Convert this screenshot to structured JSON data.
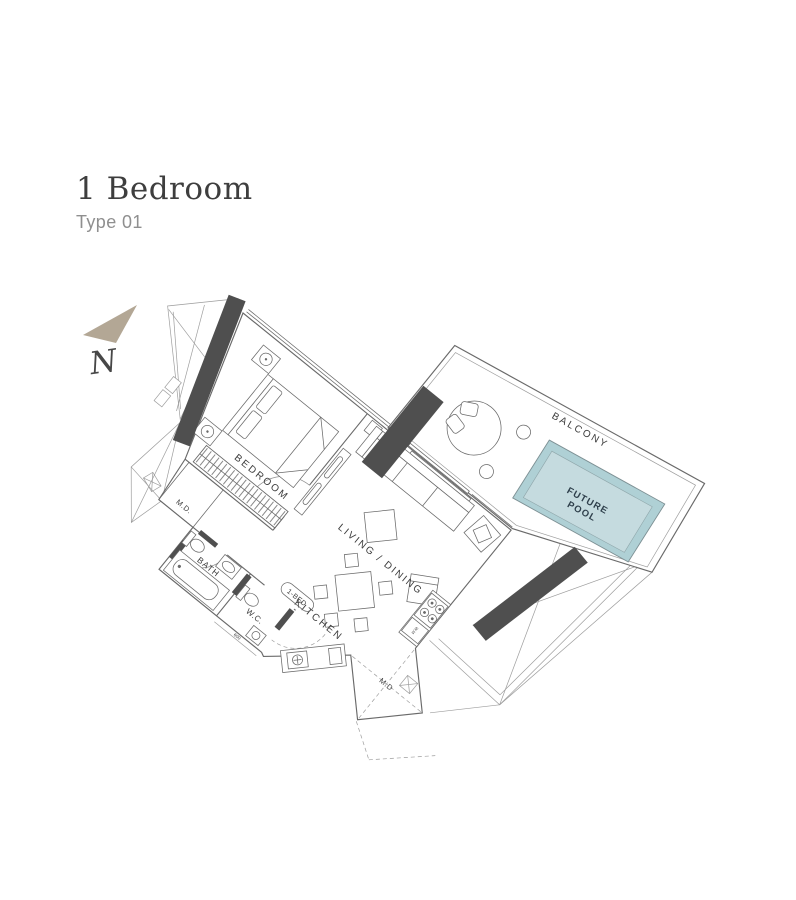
{
  "header": {
    "title": "1 Bedroom",
    "subtitle": "Type 01"
  },
  "compass": {
    "label": "N"
  },
  "floorplan": {
    "rooms": {
      "bedroom": "BEDROOM",
      "living_dining": "LIVING / DINING",
      "kitchen": "KITCHEN",
      "bath": "BATH",
      "wc": "W.C.",
      "balcony": "BALCONY"
    },
    "pool": {
      "line1": "FUTURE",
      "line2": "POOL"
    },
    "doors": {
      "maid_door_left": "M.D.",
      "main_door_entry": "M.D",
      "unit_tag": "1-BED"
    },
    "appliances": {
      "washing_machine": "W.M"
    },
    "dimensions": {
      "wc_opening": "600"
    }
  },
  "colors": {
    "wall_dark": "#4f4f4f",
    "line": "#6a6a6a",
    "line_light": "#9e9e9e",
    "pool_fill": "#c5dbdf",
    "pool_rim": "#afd0d5",
    "pool_text": "#2f404c",
    "north": "#b3a795",
    "title": "#3e3e3e",
    "subtitle": "#8f8f8f",
    "label": "#3c3c3c"
  }
}
